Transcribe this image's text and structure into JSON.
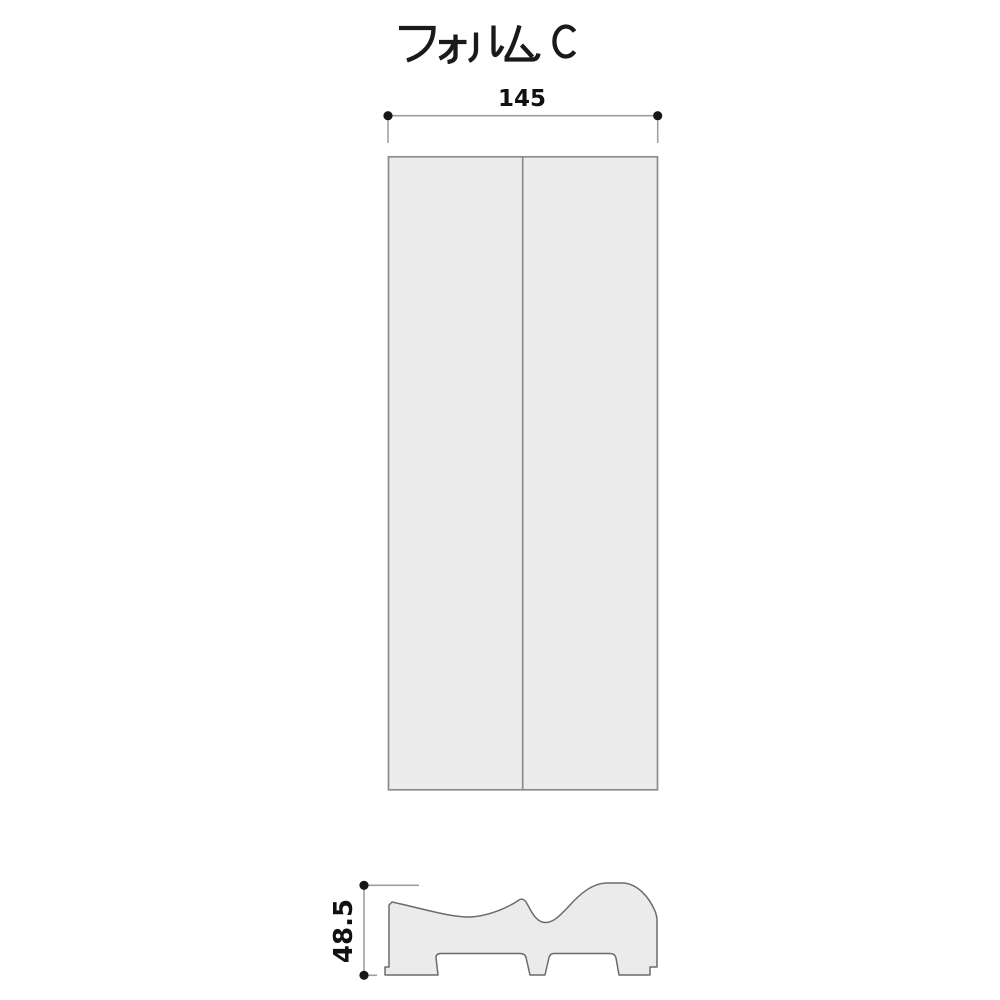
{
  "title": {
    "text": "フォルム C"
  },
  "top_view": {
    "description": "front elevation of two-panel strip",
    "width_dimension": "145"
  },
  "section_view": {
    "description": "molding cross-section profile",
    "height_dimension": "48.5"
  },
  "colors": {
    "background": "#ffffff",
    "panel_fill": "#ececec",
    "panel_stroke": "#8c8c8c",
    "profile_fill": "#ebebeb",
    "profile_stroke": "#6b6b6b",
    "dimension_line": "#9e9e9e",
    "dimension_dot": "#171717",
    "text": "#111111"
  }
}
